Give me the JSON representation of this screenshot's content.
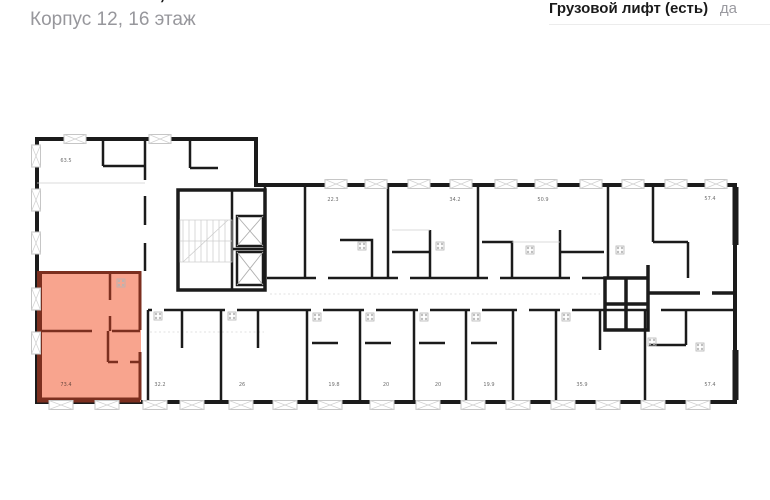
{
  "header": {
    "title": "3-комнатная, 73.4 м²",
    "subtitle": "Корпус 12, 16 этаж"
  },
  "specs": {
    "label": "Грузовой лифт (есть)",
    "value": "да"
  },
  "plan": {
    "highlight_color": "#F8A48E",
    "highlight_wall_color": "#7C2F1F",
    "wall_color": "#1B1B1B",
    "highlighted_apartment": {
      "area": "73.4",
      "x": 66,
      "y": 386
    },
    "apartments": [
      {
        "area": "63.5",
        "x": 66,
        "y": 162
      },
      {
        "area": "22.3",
        "x": 333,
        "y": 201
      },
      {
        "area": "34.2",
        "x": 455,
        "y": 201
      },
      {
        "area": "50.9",
        "x": 543,
        "y": 201
      },
      {
        "area": "57.4",
        "x": 710,
        "y": 200
      },
      {
        "area": "32.2",
        "x": 160,
        "y": 386
      },
      {
        "area": "26",
        "x": 242,
        "y": 386
      },
      {
        "area": "19.8",
        "x": 334,
        "y": 386
      },
      {
        "area": "20",
        "x": 386,
        "y": 386
      },
      {
        "area": "20",
        "x": 438,
        "y": 386
      },
      {
        "area": "19.9",
        "x": 489,
        "y": 386
      },
      {
        "area": "35.9",
        "x": 582,
        "y": 386
      },
      {
        "area": "57.4",
        "x": 710,
        "y": 386
      }
    ]
  }
}
